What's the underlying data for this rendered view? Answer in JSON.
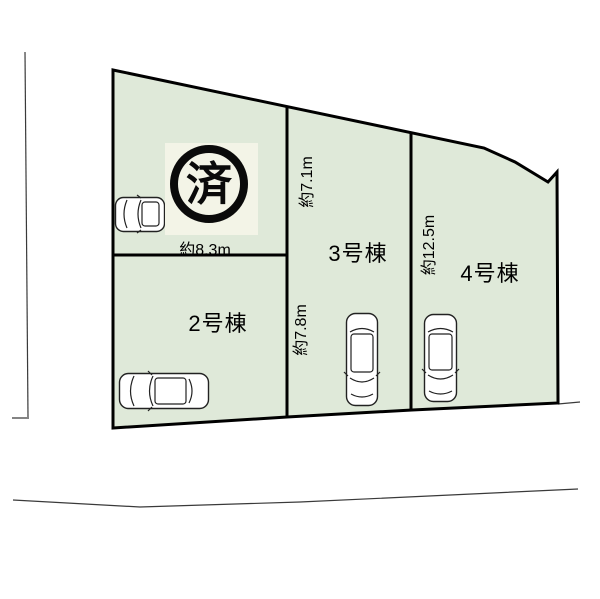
{
  "colors": {
    "background": "#ffffff",
    "plot_fill": "#dfe9d9",
    "outline": "#000000",
    "sold_bg": "#f3f4e7"
  },
  "plots": {
    "plot1_sold_mark": "済",
    "plot2_label": "2号棟",
    "plot3_label": "3号棟",
    "plot4_label": "4号棟"
  },
  "measurements": {
    "front_width": "約8.3m",
    "depth_upper": "約7.1m",
    "depth_lower": "約7.8m",
    "depth_right": "約12.5m"
  }
}
